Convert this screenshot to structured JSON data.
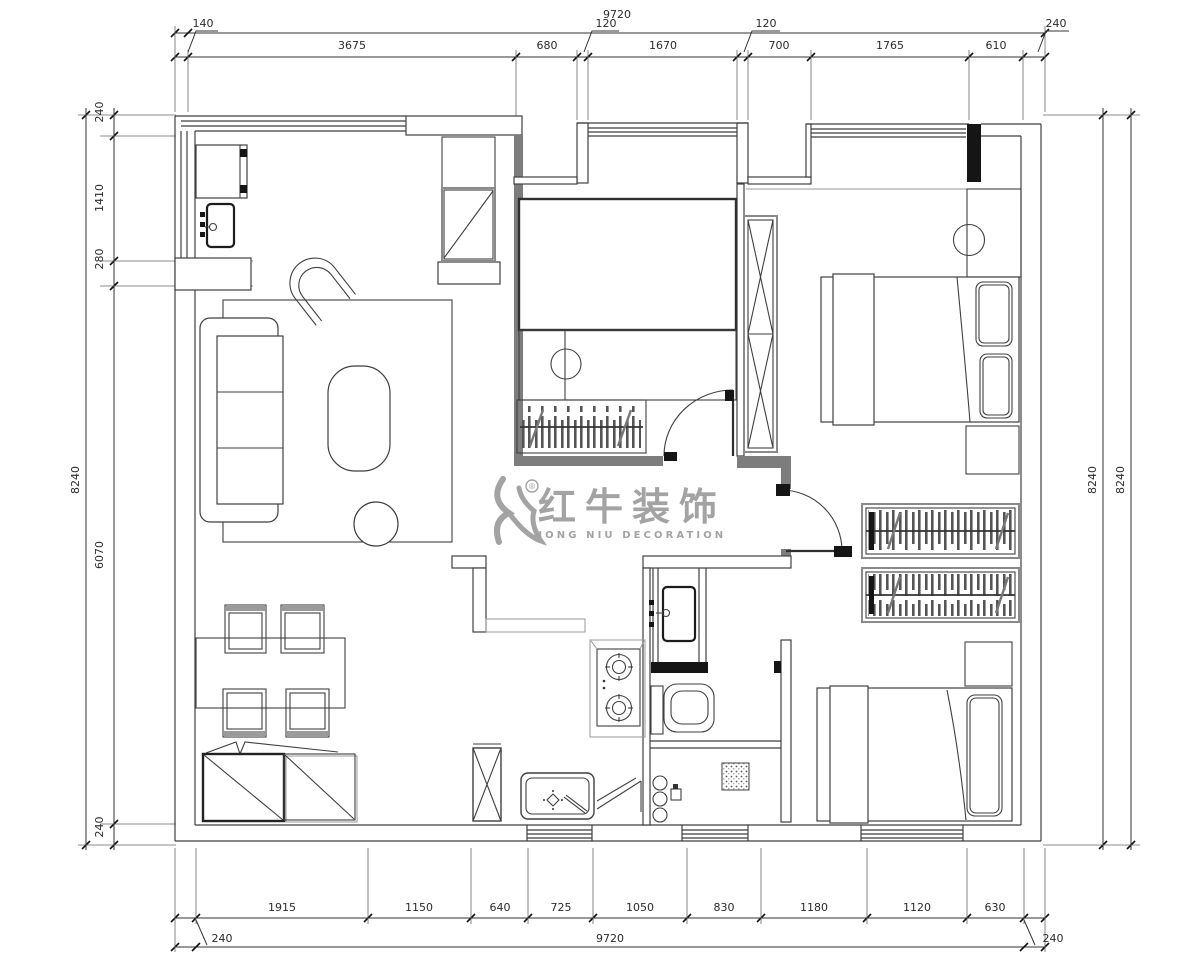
{
  "colors": {
    "line": "#3f3f3f",
    "wall_fill": "#7d7d7d",
    "solid_pier": "#151515",
    "watermark": "#9a9a9a"
  },
  "watermark": {
    "cn": "红牛装饰",
    "en": "HONG NIU DECORATION",
    "reg": "®"
  },
  "dims": {
    "top": {
      "overall": "9720",
      "offsets": [
        "140",
        "120",
        "120",
        "240"
      ],
      "segments": [
        "3675",
        "680",
        "1670",
        "700",
        "1765",
        "610"
      ]
    },
    "bottom": {
      "overall": "9720",
      "offsets": [
        "240",
        "240"
      ],
      "segments": [
        "1915",
        "1150",
        "640",
        "725",
        "1050",
        "830",
        "1180",
        "1120",
        "630"
      ]
    },
    "left": {
      "overall": "8240",
      "segments": [
        "240",
        "1410",
        "280",
        "6070",
        "240"
      ]
    },
    "right": {
      "outer": "8240",
      "inner": "8240"
    }
  }
}
